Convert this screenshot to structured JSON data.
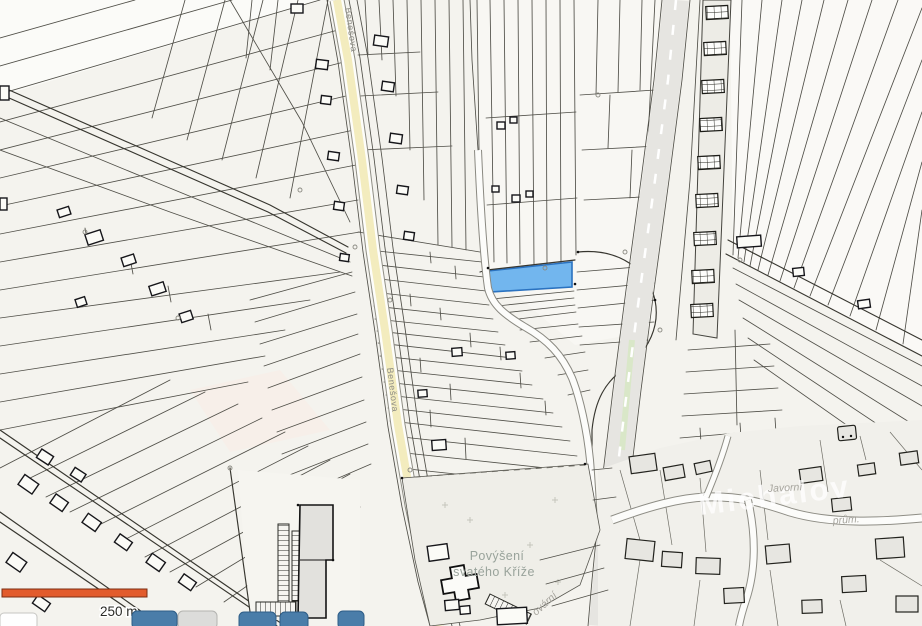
{
  "map": {
    "background": "#f4f3ee",
    "colors": {
      "parcel_line": "#504f48",
      "building_outline": "#16161a",
      "road_yellow": "#f3ecbe",
      "road_gray": "#e6e5e1",
      "green_verge": "#d9e7c8",
      "urban_building": "#e7e6e1"
    },
    "selected_parcel": {
      "fill": "#72b6ee",
      "stroke": "#2a72c0"
    },
    "labels": {
      "church": {
        "line1": "Povýšení",
        "line2": "svatého Kříže",
        "color": "#99a39b"
      },
      "road_name": "Benešova",
      "street_fragment": "ovární",
      "street_small": "Javorní",
      "street_abbrev": "prům.",
      "watermark": "Michalov"
    },
    "scale_bar": {
      "label": "250 m",
      "color": "#e25b2c",
      "border": "#7c2d12"
    },
    "toolbar": {
      "button_color": "#4a7da9",
      "button_border": "#2e5d87",
      "gray_button": "#dcdcda",
      "visible_blue_buttons": 4,
      "visible_gray_buttons": 1
    }
  }
}
